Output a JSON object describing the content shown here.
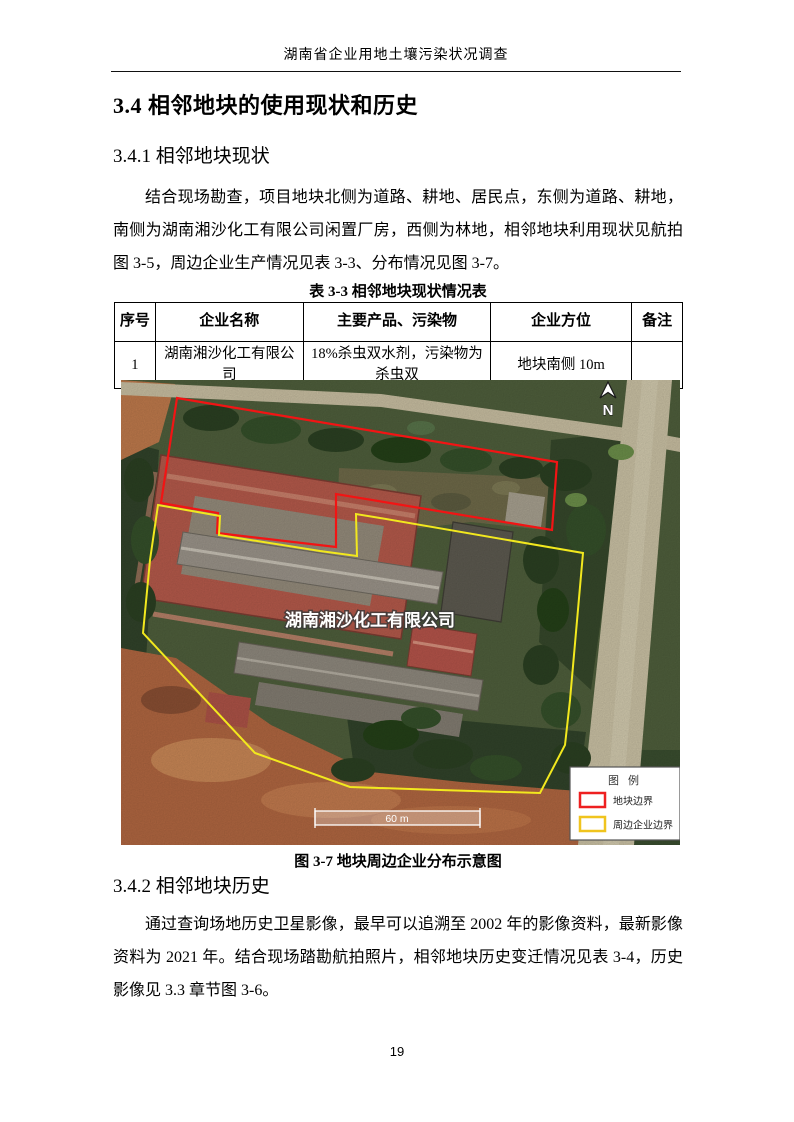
{
  "header": {
    "doc_title": "湖南省企业用地土壤污染状况调查"
  },
  "headings": {
    "section": "3.4 相邻地块的使用现状和历史",
    "sub1": "3.4.1 相邻地块现状",
    "sub2": "3.4.2 相邻地块历史"
  },
  "paragraphs": {
    "status": "结合现场勘查，项目地块北侧为道路、耕地、居民点，东侧为道路、耕地，南侧为湖南湘沙化工有限公司闲置厂房，西侧为林地，相邻地块利用现状见航拍图 3-5，周边企业生产情况见表 3-3、分布情况见图 3-7。",
    "history": "通过查询场地历史卫星影像，最早可以追溯至 2002 年的影像资料，最新影像资料为 2021 年。结合现场踏勘航拍照片，相邻地块历史变迁情况见表 3-4，历史影像见 3.3 章节图 3-6。"
  },
  "table": {
    "title": "表 3-3 相邻地块现状情况表",
    "headers": [
      "序号",
      "企业名称",
      "主要产品、污染物",
      "企业方位",
      "备注"
    ],
    "rows": [
      [
        "1",
        "湖南湘沙化工有限公司",
        "18%杀虫双水剂，污染物为杀虫双",
        "地块南侧 10m",
        ""
      ]
    ]
  },
  "figure": {
    "caption": "图 3-7 地块周边企业分布示意图",
    "company_label": "湖南湘沙化工有限公司",
    "north_label": "N",
    "scale_label": "60 m",
    "boundary_colors": {
      "site": "#f21414",
      "surrounding": "#f2e81e"
    },
    "legend": {
      "title": "图 例",
      "items": [
        {
          "label": "地块边界",
          "color": "#ee2020"
        },
        {
          "label": "周边企业边界",
          "color": "#f0c41e"
        }
      ]
    }
  },
  "footer": {
    "page_number": "19"
  }
}
